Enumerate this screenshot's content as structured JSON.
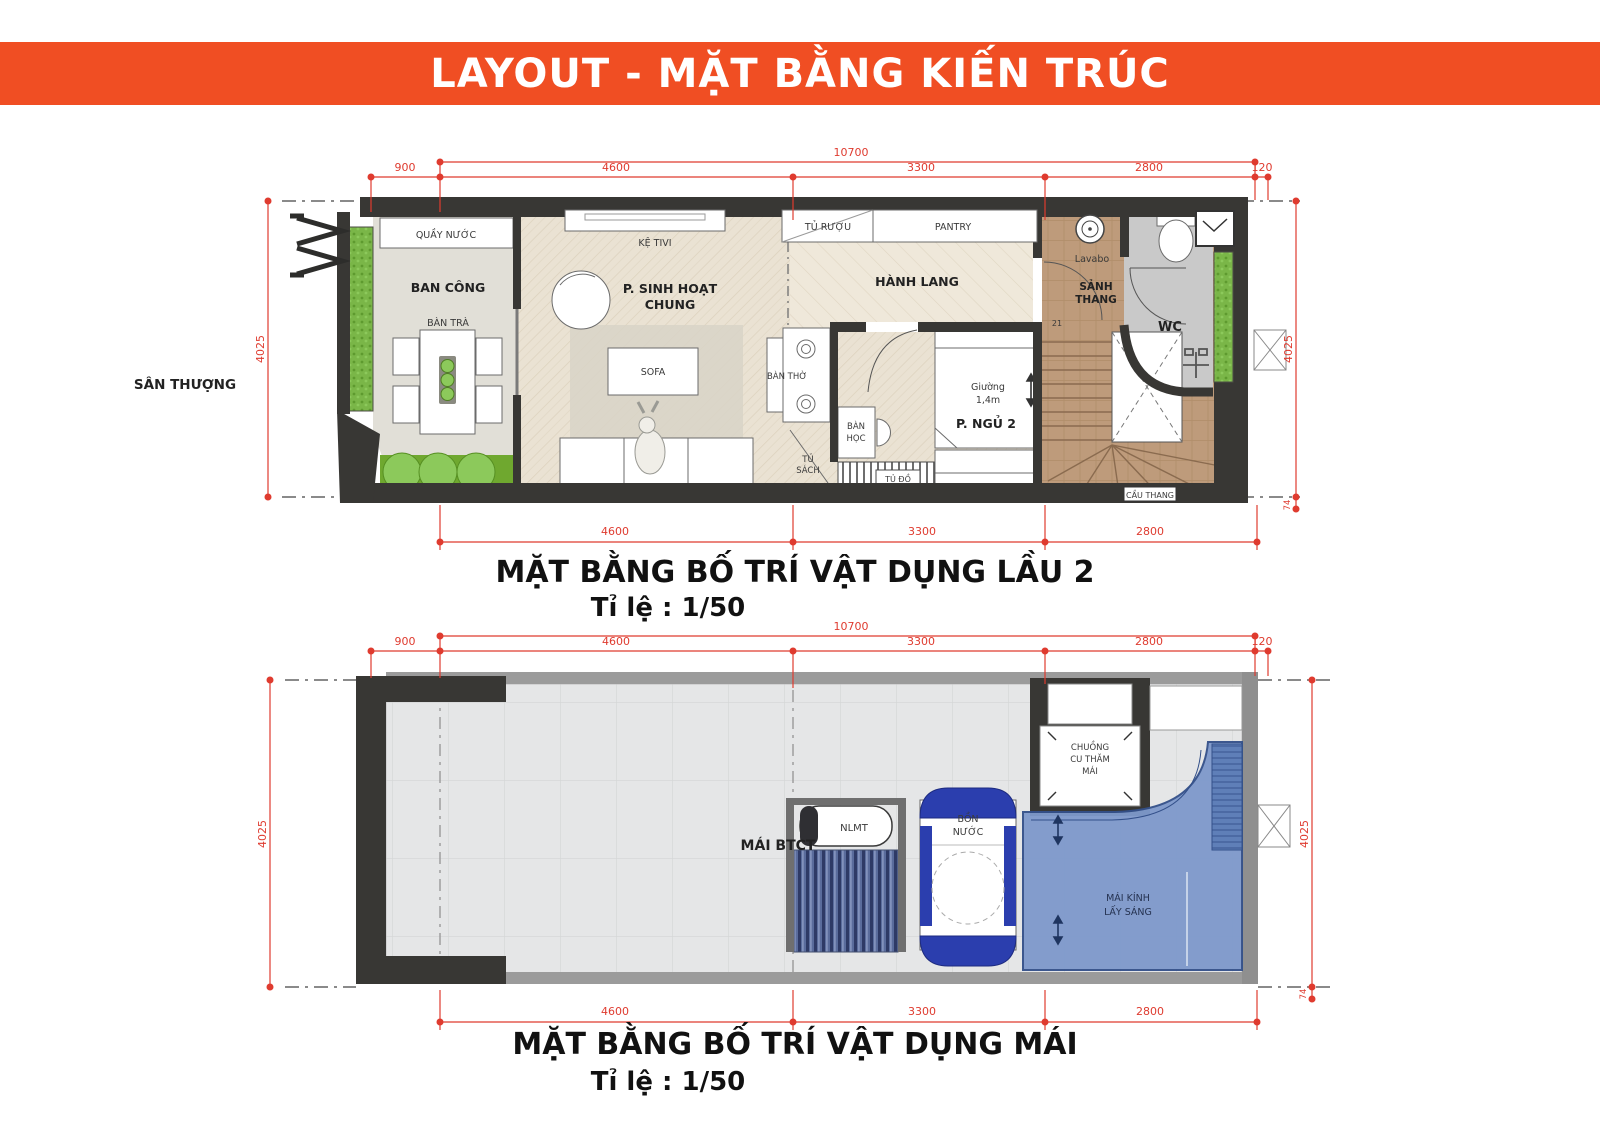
{
  "banner": {
    "title": "LAYOUT - MẶT BẰNG KIẾN TRÚC",
    "bg_color": "#F04E23"
  },
  "colors": {
    "dim_red": "#DF3B2F",
    "wall_dark": "#383734",
    "accent_green": "#7AB648",
    "skylight_blue": "#7E99CB"
  },
  "floor2": {
    "title": "MẶT BẰNG BỐ TRÍ VẬT DỤNG LẦU 2",
    "scale_label": "Tỉ lệ : 1/50",
    "outside_label": "SÂN THƯỢNG",
    "dims": {
      "total_top": "10700",
      "seg_900": "900",
      "seg_4600": "4600",
      "seg_3300": "3300",
      "seg_2800": "2800",
      "seg_120": "120",
      "bottom_4600": "4600",
      "bottom_3300": "3300",
      "bottom_2800": "2800",
      "left": "4025",
      "right": "4025",
      "right_small": "74"
    },
    "rooms": {
      "quay_nuoc": "QUẦY NƯỚC",
      "ban_cong": "BAN CÔNG",
      "ban_tra": "BÀN TRÀ",
      "ke_tivi": "KỆ TIVI",
      "sinh_hoat_line1": "P. SINH HOẠT",
      "sinh_hoat_line2": "CHUNG",
      "sofa": "SOFA",
      "tu_ruou": "TỦ RƯỢU",
      "pantry": "PANTRY",
      "hanh_lang": "HÀNH LANG",
      "ban_tho": "BÀN THỜ",
      "tu_sach_line1": "TỦ",
      "tu_sach_line2": "SÁCH",
      "ban_hoc_line1": "BÀN",
      "ban_hoc_line2": "HỌC",
      "giuong_line1": "Giường",
      "giuong_line2": "1,4m",
      "p_ngu_2": "P. NGỦ 2",
      "tu_do": "TỦ ĐỒ",
      "lavabo": "Lavabo",
      "sanh_thang_line1": "SẢNH",
      "sanh_thang_line2": "THANG",
      "stair_count": "21",
      "wc": "WC",
      "cau_thang": "CẦU THANG"
    }
  },
  "roof": {
    "title": "MẶT BẰNG BỐ TRÍ VẬT DỤNG MÁI",
    "scale_label": "Tỉ lệ : 1/50",
    "dims": {
      "total_top": "10700",
      "seg_900": "900",
      "seg_4600": "4600",
      "seg_3300": "3300",
      "seg_2800": "2800",
      "seg_120": "120",
      "bottom_4600": "4600",
      "bottom_3300": "3300",
      "bottom_2800": "2800",
      "left": "4025",
      "right": "4025",
      "right_small": "74"
    },
    "rooms": {
      "mai_btct": "MÁI BTCT",
      "nlmt": "NLMT",
      "bon_nuoc_line1": "BỒN",
      "bon_nuoc_line2": "NƯỚC",
      "chuong_cu_line1": "CHUỒNG",
      "chuong_cu_line2": "CU THĂM",
      "chuong_cu_line3": "MÁI",
      "mai_kinh_line1": "MÁI KÍNH",
      "mai_kinh_line2": "LẤY SÁNG"
    }
  }
}
